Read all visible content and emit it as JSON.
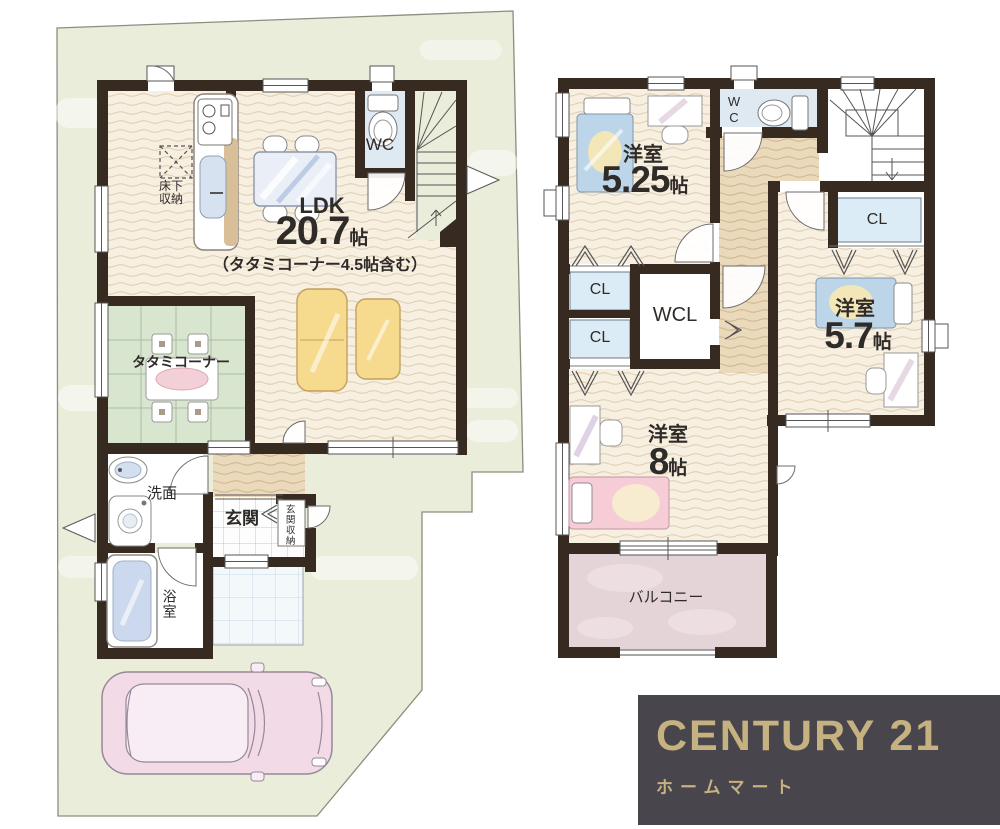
{
  "floor1": {
    "ldk_label": "LDK",
    "ldk_size": "20.7",
    "ldk_unit": "帖",
    "ldk_note": "（タタミコーナー4.5帖含む）",
    "wc": "WC",
    "underfloor_line1": "床下",
    "underfloor_line2": "収納",
    "tatami_corner": "タタミコーナー",
    "washroom": "洗面",
    "entrance": "玄関",
    "entrance_storage": "玄関収納",
    "bathroom": "浴室"
  },
  "floor2": {
    "room525_label": "洋室",
    "room525_size": "5.25",
    "room525_unit": "帖",
    "wc": "WC",
    "closet1": "CL",
    "closet2": "CL",
    "closet3": "CL",
    "walkin_closet": "WCL",
    "room57_label": "洋室",
    "room57_size": "5.7",
    "room57_unit": "帖",
    "room8_label": "洋室",
    "room8_size": "8",
    "room8_unit": "帖",
    "balcony": "バルコニー"
  },
  "logo": {
    "brand": "CENTURY 21",
    "company": "ホームマート"
  },
  "colors": {
    "wall": "#362a21",
    "site": "#e9edda",
    "wood_floor": "#f7efe0",
    "tatami": "#d9e6cf",
    "closet_fill": "#dcecf7",
    "wc_floor": "#dfe9f2",
    "balcony": "#e4d3d7",
    "logo_bg": "#48454c",
    "logo_gold": "#c6b181"
  }
}
